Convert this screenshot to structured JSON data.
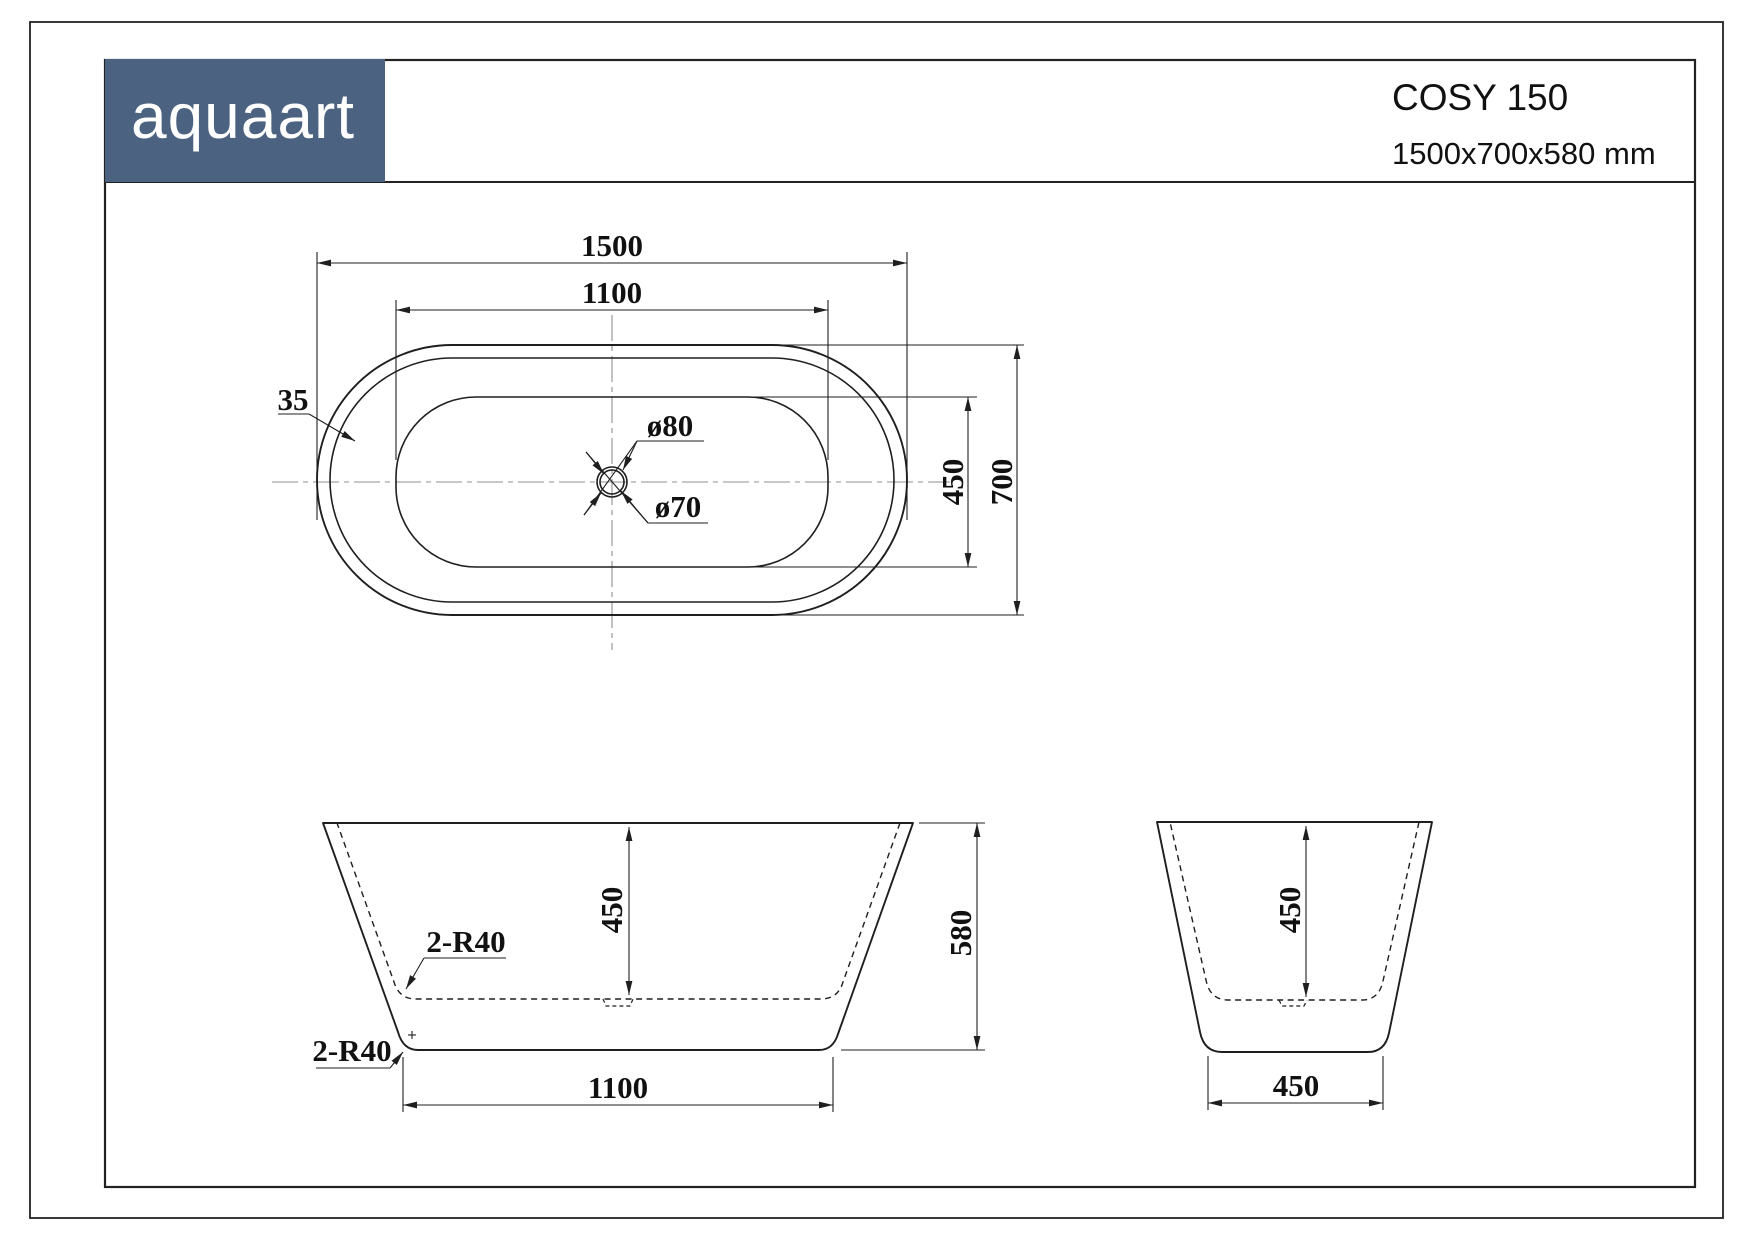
{
  "header": {
    "logo": "aquaart",
    "model": "COSY 150",
    "size": "1500x700x580 mm"
  },
  "colors": {
    "logo_bg": "#4b6380",
    "line": "#1f1f1f",
    "centerline": "#8f8f8f"
  },
  "top_view": {
    "length": "1500",
    "inner_length": "1100",
    "rim_width": "35",
    "drain_outer": "ø80",
    "drain_inner": "ø70",
    "inner_width": "450",
    "width": "700"
  },
  "side_view": {
    "inner_depth": "450",
    "height": "580",
    "bottom_length": "1100",
    "inner_corner_radius": "2-R40",
    "outer_corner_radius": "2-R40"
  },
  "end_view": {
    "inner_depth": "450",
    "bottom_width": "450"
  }
}
